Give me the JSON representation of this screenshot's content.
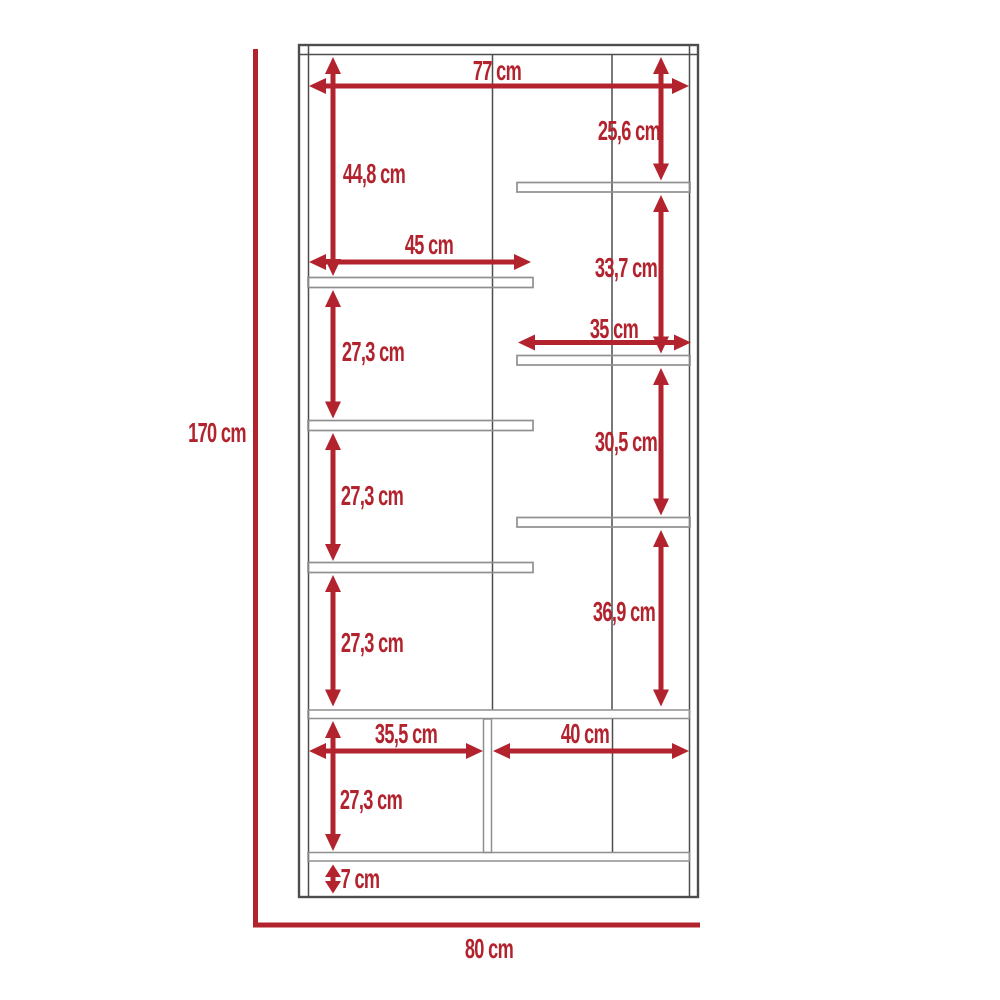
{
  "diagram": {
    "type": "furniture-dimension-drawing",
    "subject": "tall shelving cabinet, front elevation with dimension callouts",
    "unit": "cm",
    "colors": {
      "dimension_red": "#b2232e",
      "frame_dark": "#4d4d4d",
      "panel_light": "#8f8f8f",
      "background": "#ffffff"
    },
    "dimensions": {
      "overall_height": {
        "label": "170 cm",
        "value": 170
      },
      "overall_width": {
        "label": "80 cm",
        "value": 80
      },
      "inner_width": {
        "label": "77 cm",
        "value": 77
      },
      "top_left_section_height": {
        "label": "44,8 cm",
        "value": 44.8
      },
      "top_right_section_height": {
        "label": "25,6 cm",
        "value": 25.6
      },
      "left_shelf_width": {
        "label": "45 cm",
        "value": 45
      },
      "right_section_2_height": {
        "label": "33,7 cm",
        "value": 33.7
      },
      "left_section_2_height": {
        "label": "27,3 cm",
        "value": 27.3
      },
      "right_shelf_width": {
        "label": "35 cm",
        "value": 35
      },
      "right_section_3_height": {
        "label": "30,5 cm",
        "value": 30.5
      },
      "left_section_3_height": {
        "label": "27,3 cm",
        "value": 27.3
      },
      "right_section_4_height": {
        "label": "36,9 cm",
        "value": 36.9
      },
      "left_section_4_height": {
        "label": "27,3 cm",
        "value": 27.3
      },
      "bottom_left_width": {
        "label": "35,5 cm",
        "value": 35.5
      },
      "bottom_right_width": {
        "label": "40 cm",
        "value": 40
      },
      "bottom_section_height": {
        "label": "27,3 cm",
        "value": 27.3
      },
      "base_height": {
        "label": "7 cm",
        "value": 7
      }
    }
  }
}
